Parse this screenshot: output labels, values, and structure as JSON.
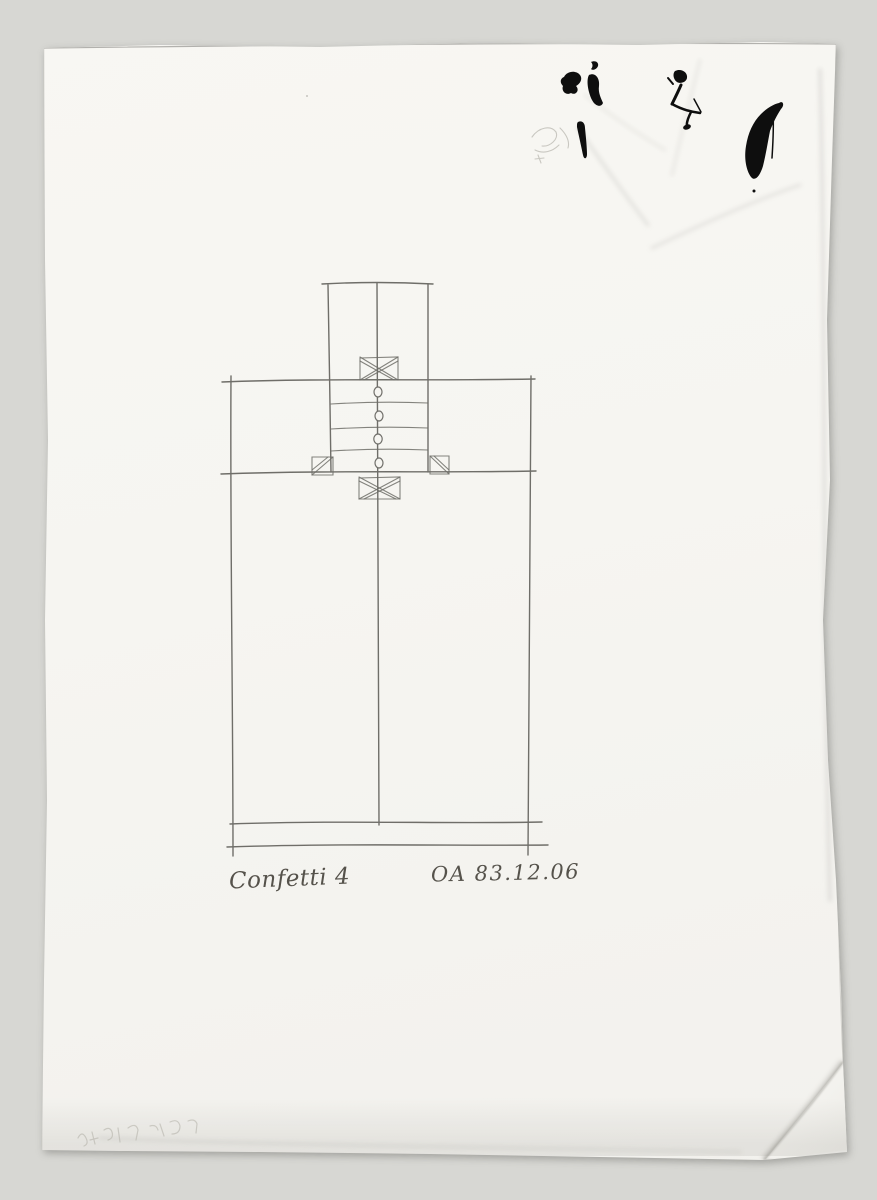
{
  "scan": {
    "inscriptions": {
      "title": "Confetti 4",
      "date_code": "OA 83.12.06"
    },
    "palette": {
      "background": "#d7d7d3",
      "paper": "#f6f5f1",
      "pencil": "#6f6e69",
      "ink": "#0e0e0e",
      "handwriting": "#55524b"
    }
  }
}
